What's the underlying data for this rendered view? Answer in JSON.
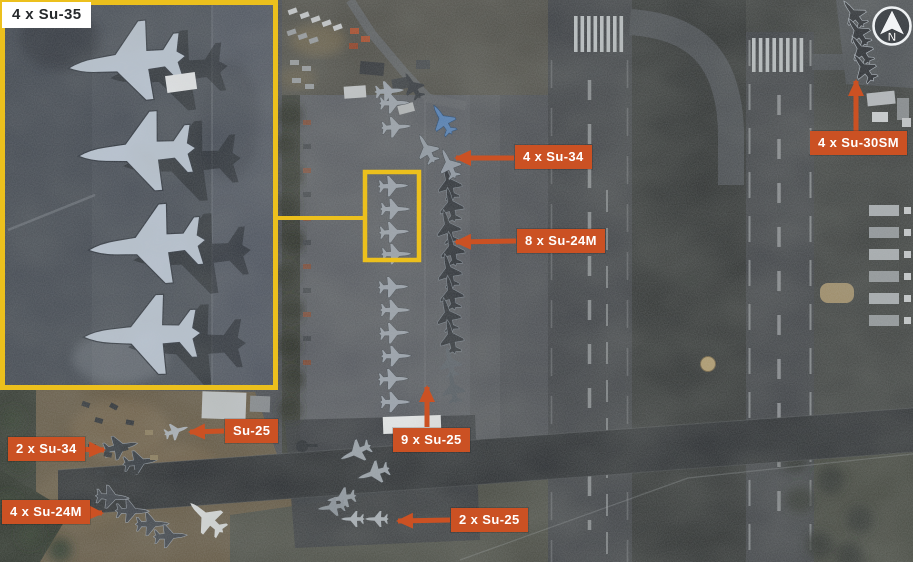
{
  "title": "Annotated satellite image of an airbase with parked combat aircraft",
  "colors": {
    "annotation_orange": "#cb5123",
    "highlight_yellow": "#ecc01d",
    "annotation_text": "#ffffff",
    "inset_label_bg": "#ffffff",
    "inset_label_text": "#26292c"
  },
  "inset": {
    "label": "4 x Su-35"
  },
  "annotations": [
    {
      "id": "su34-east",
      "text": "4 x Su-34",
      "arrow": "left"
    },
    {
      "id": "su24m-east",
      "text": "8 x Su-24M",
      "arrow": "left"
    },
    {
      "id": "su30sm",
      "text": "4 x Su-30SM",
      "arrow": "up"
    },
    {
      "id": "su25-single",
      "text": "Su-25",
      "arrow": "left"
    },
    {
      "id": "su34-west",
      "text": "2 x Su-34",
      "arrow": "right"
    },
    {
      "id": "su24m-west",
      "text": "4 x Su-24M",
      "arrow": "right"
    },
    {
      "id": "su25-nine",
      "text": "9 x Su-25",
      "arrow": "up"
    },
    {
      "id": "su25-two",
      "text": "2 x Su-25",
      "arrow": "left"
    }
  ],
  "compass": {
    "letter": "N",
    "icon": "north-arrow-icon"
  }
}
